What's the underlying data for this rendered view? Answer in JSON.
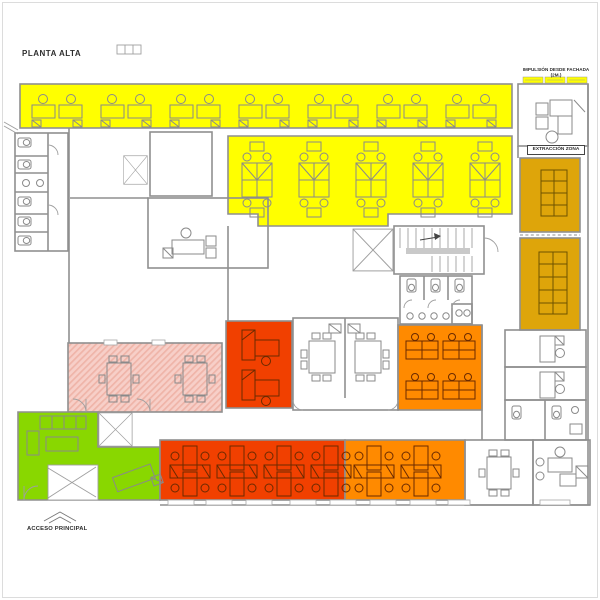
{
  "title": "PLANTA ALTA",
  "labels": {
    "impulsion": "IMPULSIÓN DESDE FACHADA (2M.)",
    "extraction": "EXTRACCIÓN ZONA",
    "access": "ACCESO PRINCIPAL"
  },
  "colors": {
    "yellow": "#FFFF00",
    "ochre": "#DEA50A",
    "orange": "#FF8A00",
    "red": "#F14000",
    "green": "#89D700",
    "pink": "#F7CFC8",
    "pink_hatch": "#EFB4A8",
    "wall": "#8F8F8F"
  },
  "zones": [
    {
      "name": "open-office-north",
      "color": "#FFFF00"
    },
    {
      "name": "open-office-core",
      "color": "#FFFF00"
    },
    {
      "name": "meeting-room-east-north",
      "color": "#DEA50A"
    },
    {
      "name": "meeting-room-east-south",
      "color": "#DEA50A"
    },
    {
      "name": "private-office-red",
      "color": "#F14000"
    },
    {
      "name": "open-office-orange-core",
      "color": "#FF8A00"
    },
    {
      "name": "workstation-band-red-south",
      "color": "#F14000"
    },
    {
      "name": "workstation-band-orange-south",
      "color": "#FF8A00"
    },
    {
      "name": "training-room-pink",
      "color": "#F7CFC8"
    },
    {
      "name": "reception-lounge-green",
      "color": "#89D700"
    }
  ]
}
